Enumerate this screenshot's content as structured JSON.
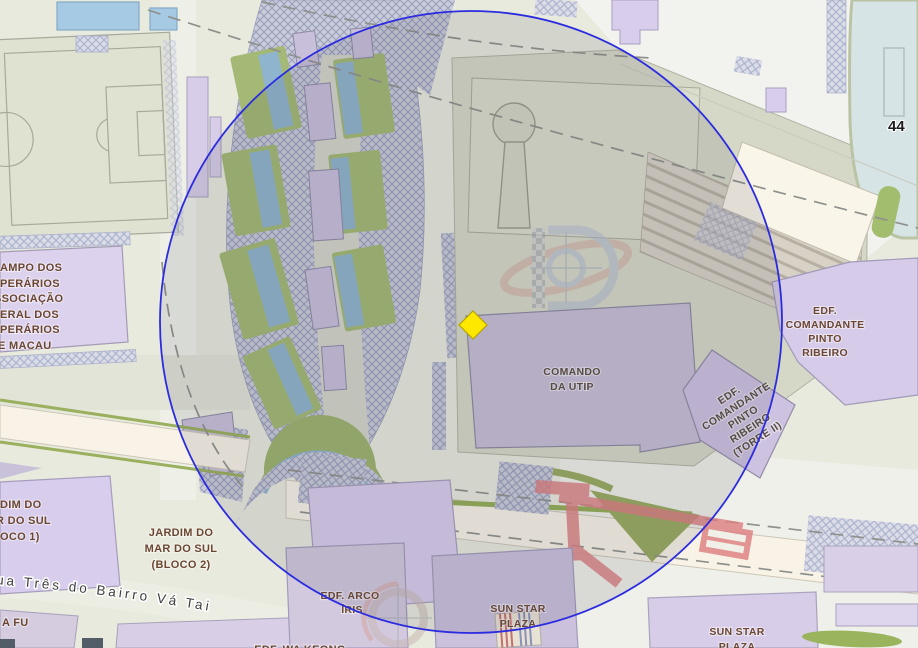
{
  "overlay": {
    "circle_stroke_color": "#2b2be0",
    "marker_color": "#ffe800",
    "bridge_red": "#dd8080"
  },
  "colors": {
    "building_purple": "#d8cdec",
    "building_purple_dim": "#c7bed6",
    "park_green": "#a3b975",
    "water_blue": "#8fb4cd",
    "pool_blue": "#a6c9e4",
    "label_brown": "#6b4732",
    "cream_band": "#f8f3e6"
  },
  "labels": {
    "campo_operarios": {
      "lines": [
        "AMPO DOS",
        "PERÁRIOS",
        "SSOCIAÇÃO",
        "ERAL DOS",
        "PERÁRIOS",
        "E MACAU"
      ]
    },
    "comando_da_utip": {
      "lines": [
        "COMANDO",
        "DA UTIP"
      ]
    },
    "edf_comandante_pinto_ribeiro": {
      "lines": [
        "EDF.",
        "COMANDANTE",
        "PINTO",
        "RIBEIRO"
      ]
    },
    "edf_comandante_pinto_ribeiro_torre_ii": {
      "lines": [
        "EDF.",
        "COMANDANTE",
        "PINTO",
        "RIBEIRO",
        "(TORRE II)"
      ]
    },
    "jardim_do_mar_do_sul_bloco1": {
      "lines": [
        "DIM DO",
        "R DO SUL",
        "OCO 1)"
      ]
    },
    "jardim_do_mar_do_sul_bloco2": {
      "lines": [
        "JARDIM DO",
        "MAR DO SUL",
        "(BLOCO 2)"
      ]
    },
    "edf_arco_iris": {
      "lines": [
        "EDF. ARCO",
        "ÍRIS"
      ]
    },
    "sun_star_plaza_west": {
      "lines": [
        "SUN STAR",
        "PLAZA"
      ]
    },
    "sun_star_plaza_east": {
      "lines": [
        "SUN STAR",
        "PLAZA"
      ]
    },
    "va_fu": "A FU",
    "edf_wa_keong": "EDF. WA KEONG",
    "street_name": "ua Três do Bairro Vá Tai",
    "pool_number": "44"
  }
}
